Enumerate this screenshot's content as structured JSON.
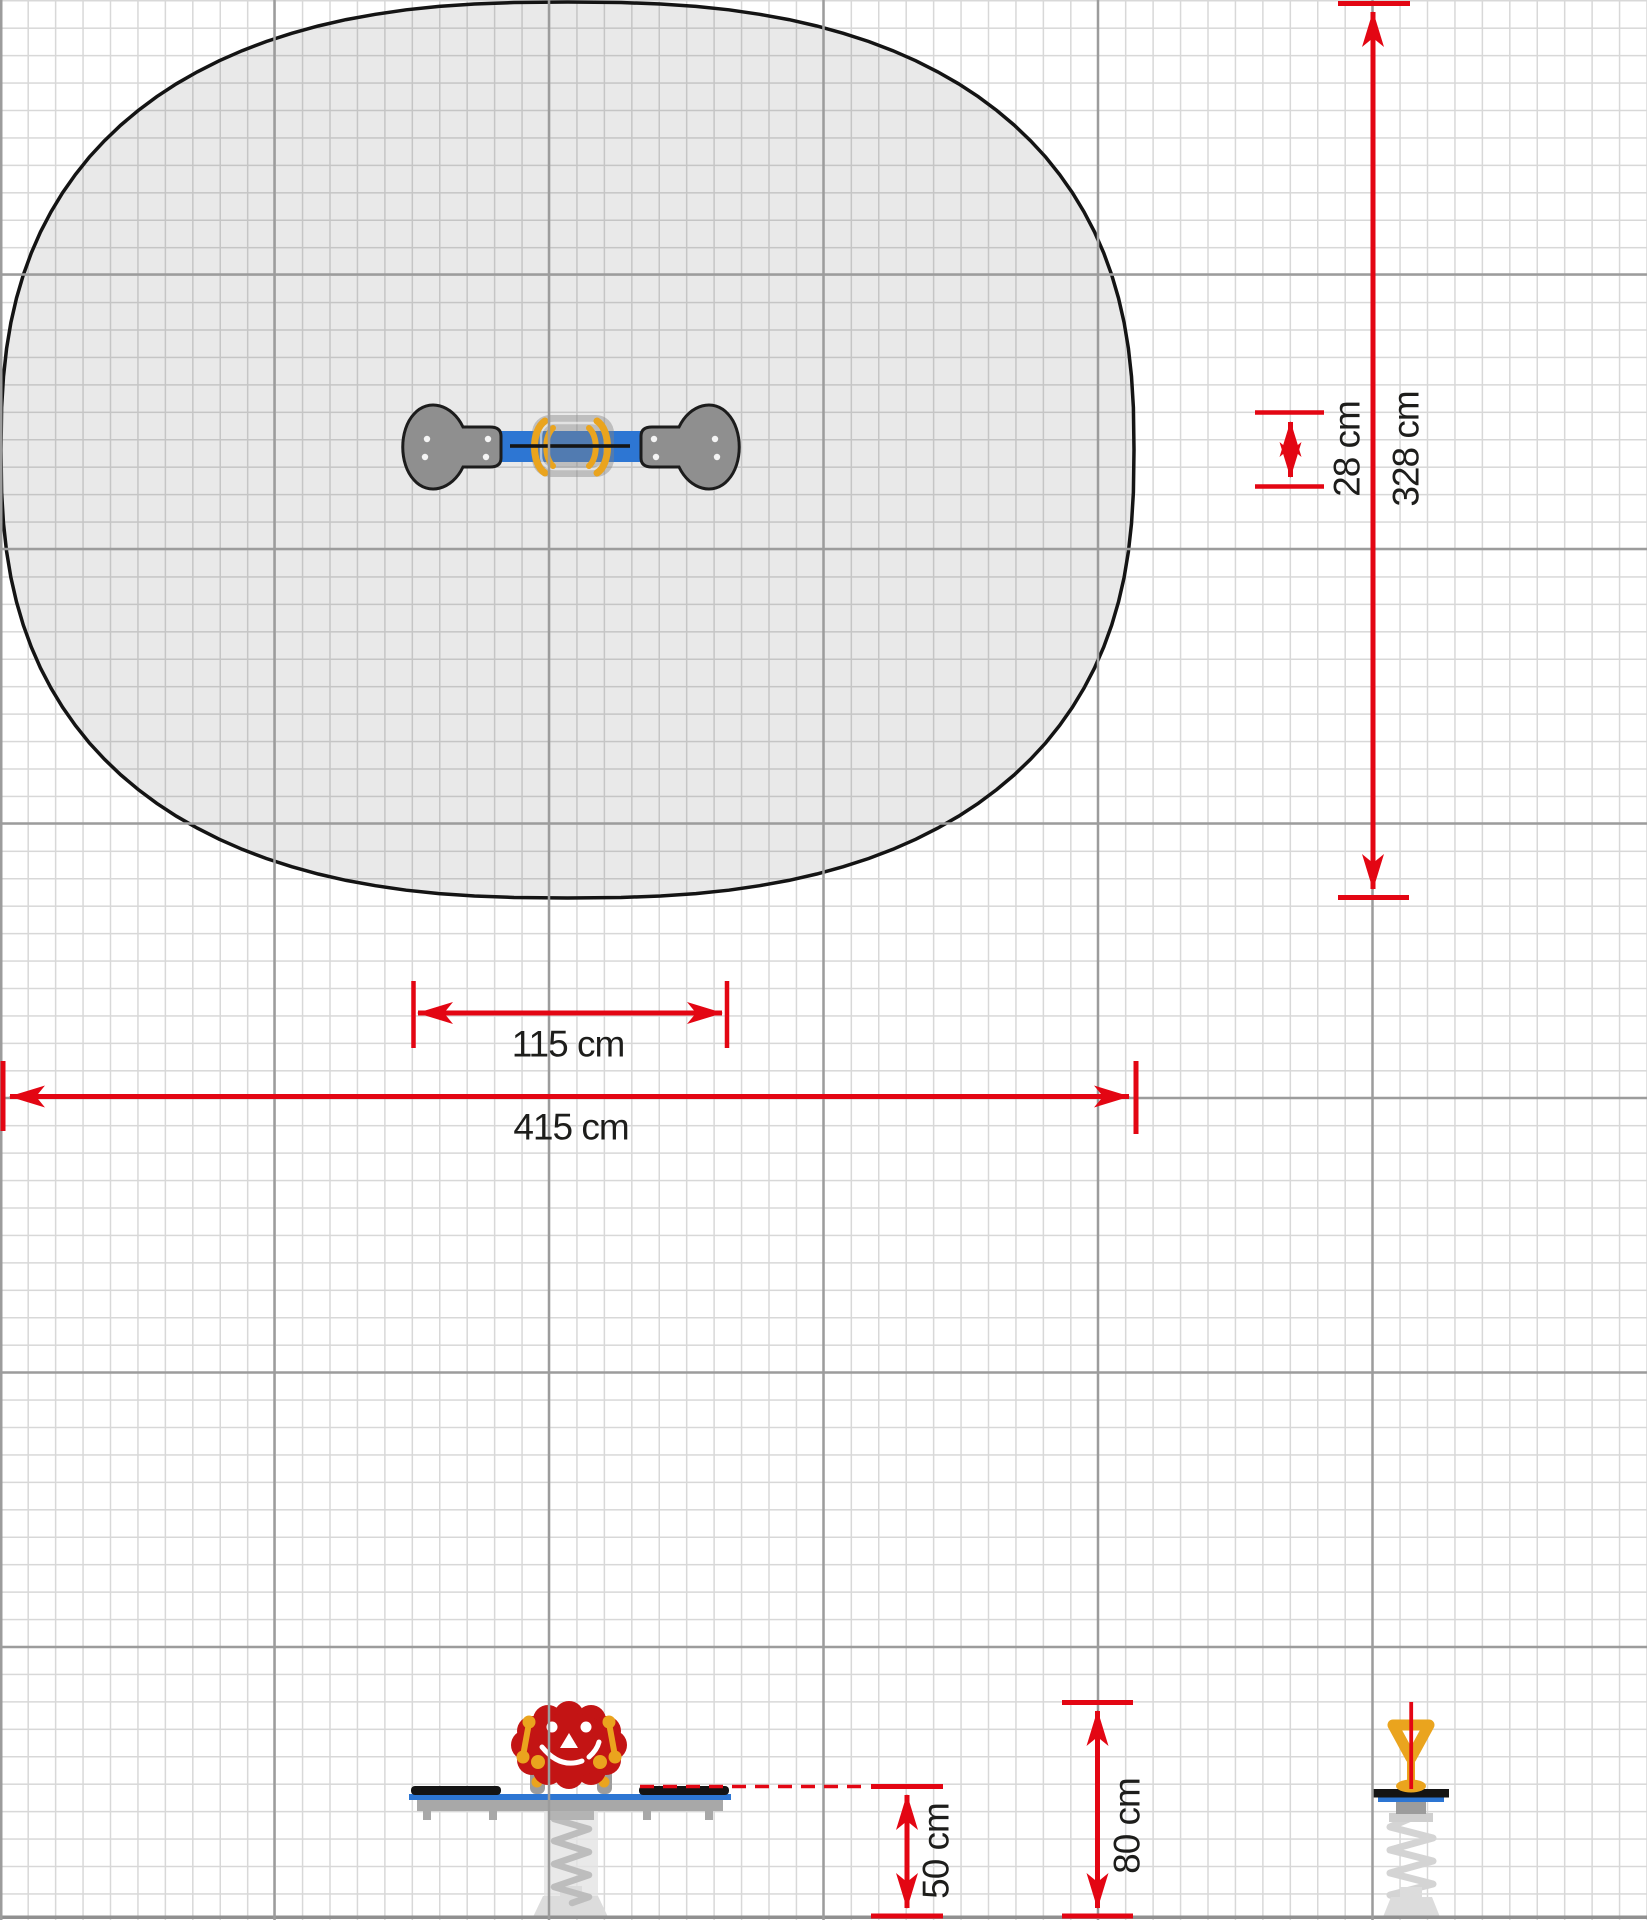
{
  "drawing": {
    "kind": "playground spring-rocker installation plan, top view with safety zone and two elevation views",
    "grid_cell": "10 cm"
  },
  "colors": {
    "dimension_red": "#e30613",
    "beam_blue": "#2d76d3",
    "equipment_gray": "#8f8f8f",
    "rocker_head_red": "#c31414",
    "handle_yellow": "#eaa41e",
    "zone_fill": "rgba(0,0,0,0.085)",
    "zone_outline": "#141414",
    "grid_minor": "#d8d8d8",
    "grid_major": "#9c9c9c",
    "ground": "#909090"
  },
  "dimensions": {
    "equipment_length": {
      "label": "115 cm"
    },
    "zone_length": {
      "label": "415 cm"
    },
    "equipment_width": {
      "label": "28 cm"
    },
    "zone_width": {
      "label": "328 cm"
    },
    "seat_height": {
      "label": "50 cm"
    },
    "handle_height": {
      "label": "80 cm"
    }
  },
  "icons": {
    "top_view": "seesaw-top-view-icon",
    "side_view": "spring-rocker-side-view-icon",
    "end_view": "spring-rocker-end-view-icon"
  }
}
